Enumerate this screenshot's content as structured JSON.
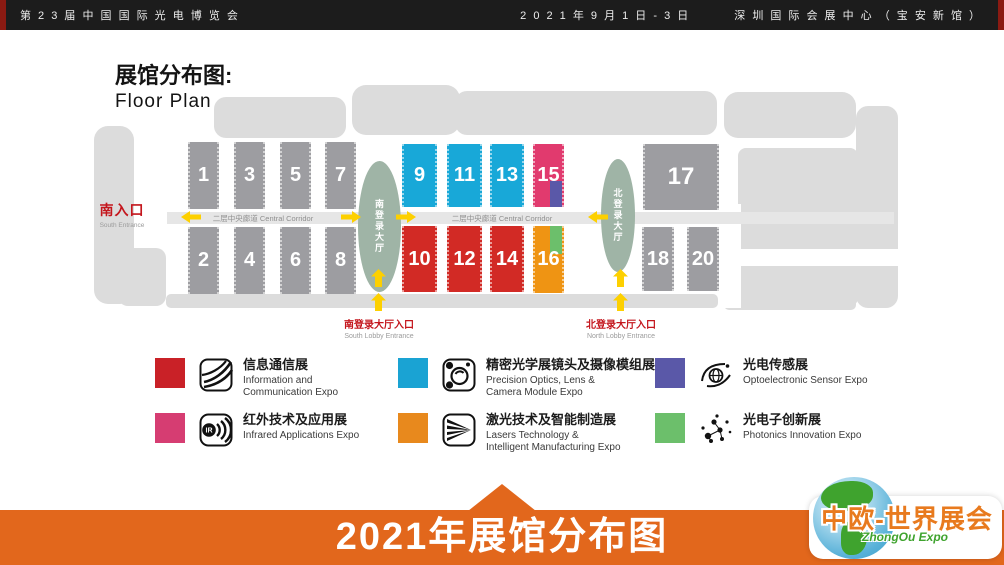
{
  "top_bar": {
    "title": "第 2 3 届 中 国 国 际 光 电 博 览 会",
    "date": "2 0 2 1 年 9 月 1 日 - 3 日",
    "venue": "深 圳 国 际 会 展 中 心 （ 宝 安 新 馆 ）"
  },
  "header": {
    "title_zh": "展馆分布图:",
    "title_en": "Floor Plan"
  },
  "map": {
    "south_entrance": {
      "zh": "南入口",
      "en": "South Entrance"
    },
    "corridor_label": "二层中央廊道 Central Corridor",
    "south_lobby_label": "南登录大厅",
    "north_lobby_label": "北登录大厅",
    "south_lobby_entrance": {
      "zh": "南登录大厅入口",
      "en": "South Lobby Entrance"
    },
    "north_lobby_entrance": {
      "zh": "北登录大厅入口",
      "en": "North Lobby Entrance"
    },
    "colors": {
      "gray": "#9d9da1",
      "cyan": "#18a8d8",
      "red": "#d22a25",
      "pink": "#e13a6e",
      "purple": "#5a58a8",
      "orange": "#ef9413",
      "green": "#6cbf6b",
      "lobby": "#9fb4a6",
      "arrow": "#fdd000",
      "silhouette": "#dcdcdc",
      "corridor_band": "#e6e6e6",
      "banner_orange": "#e2671c"
    },
    "halls": [
      {
        "num": "1",
        "color": "gray"
      },
      {
        "num": "3",
        "color": "gray"
      },
      {
        "num": "5",
        "color": "gray"
      },
      {
        "num": "7",
        "color": "gray"
      },
      {
        "num": "2",
        "color": "gray"
      },
      {
        "num": "4",
        "color": "gray"
      },
      {
        "num": "6",
        "color": "gray"
      },
      {
        "num": "8",
        "color": "gray"
      },
      {
        "num": "9",
        "color": "cyan"
      },
      {
        "num": "11",
        "color": "cyan"
      },
      {
        "num": "13",
        "color": "cyan"
      },
      {
        "num": "15",
        "color": "pink",
        "corner": {
          "color": "purple",
          "pos": "bottom-right"
        }
      },
      {
        "num": "10",
        "color": "red"
      },
      {
        "num": "12",
        "color": "red"
      },
      {
        "num": "14",
        "color": "red"
      },
      {
        "num": "16",
        "color": "orange",
        "corner": {
          "color": "green",
          "pos": "top-right"
        }
      },
      {
        "num": "17",
        "color": "gray"
      },
      {
        "num": "18",
        "color": "gray"
      },
      {
        "num": "20",
        "color": "gray"
      }
    ]
  },
  "legend": [
    {
      "icon": "fiber-optics-icon",
      "color": "#c92127",
      "zh": "信息通信展",
      "en": "Information and\nCommunication Expo"
    },
    {
      "icon": "camera-lens-icon",
      "color": "#1aa3d3",
      "zh": "精密光学展镜头及摄像模组展",
      "en": "Precision Optics, Lens &\nCamera Module Expo"
    },
    {
      "icon": "optoelectronic-sensor-icon",
      "color": "#5a58a8",
      "zh": "光电传感展",
      "en": "Optoelectronic Sensor Expo"
    },
    {
      "icon": "infrared-icon",
      "color": "#d63d72",
      "zh": "红外技术及应用展",
      "en": "Infrared Applications Expo"
    },
    {
      "icon": "laser-icon",
      "color": "#e8891d",
      "zh": "激光技术及智能制造展",
      "en": "Lasers Technology &\nIntelligent Manufacturing Expo"
    },
    {
      "icon": "photonics-icon",
      "color": "#6cbf6b",
      "zh": "光电子创新展",
      "en": "Photonics Innovation Expo"
    }
  ],
  "footer": {
    "banner": "2021年展馆分布图"
  },
  "logo": {
    "zh": "中欧-世界展会",
    "en": "ZhongOu Expo"
  }
}
